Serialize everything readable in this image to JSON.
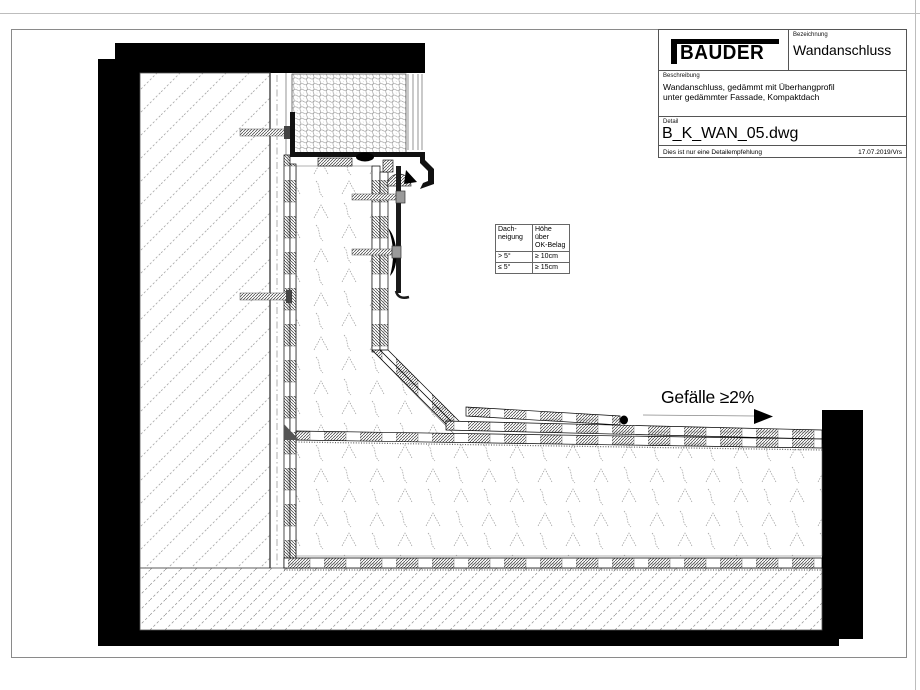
{
  "title_block": {
    "logo": "BAUDER",
    "bezeichnung_label": "Bezeichnung",
    "bezeichnung": "Wandanschluss",
    "beschreibung_label": "Beschreibung",
    "beschreibung_line1": "Wandanschluss, gedämmt mit Überhangprofil",
    "beschreibung_line2": "unter gedämmter Fassade, Kompaktdach",
    "detail_label": "Detail",
    "detail": "B_K_WAN_05.dwg",
    "note": "Dies ist nur eine Detailempfehlung",
    "date": "17.07.2019/Vrs"
  },
  "slope_table": {
    "col1_header_line1": "Dach-",
    "col1_header_line2": "neigung",
    "col2_header_line1": "Höhe über",
    "col2_header_line2": "OK-Belag",
    "rows": [
      {
        "neigung": "> 5°",
        "hoehe": "≥ 10cm"
      },
      {
        "neigung": "≤ 5°",
        "hoehe": "≥ 15cm"
      }
    ]
  },
  "annotations": {
    "slope": "Gefälle ≥2%"
  },
  "colors": {
    "ink": "#000000",
    "frame": "#8a8a8a",
    "hatch_light": "#a8a8a8"
  }
}
